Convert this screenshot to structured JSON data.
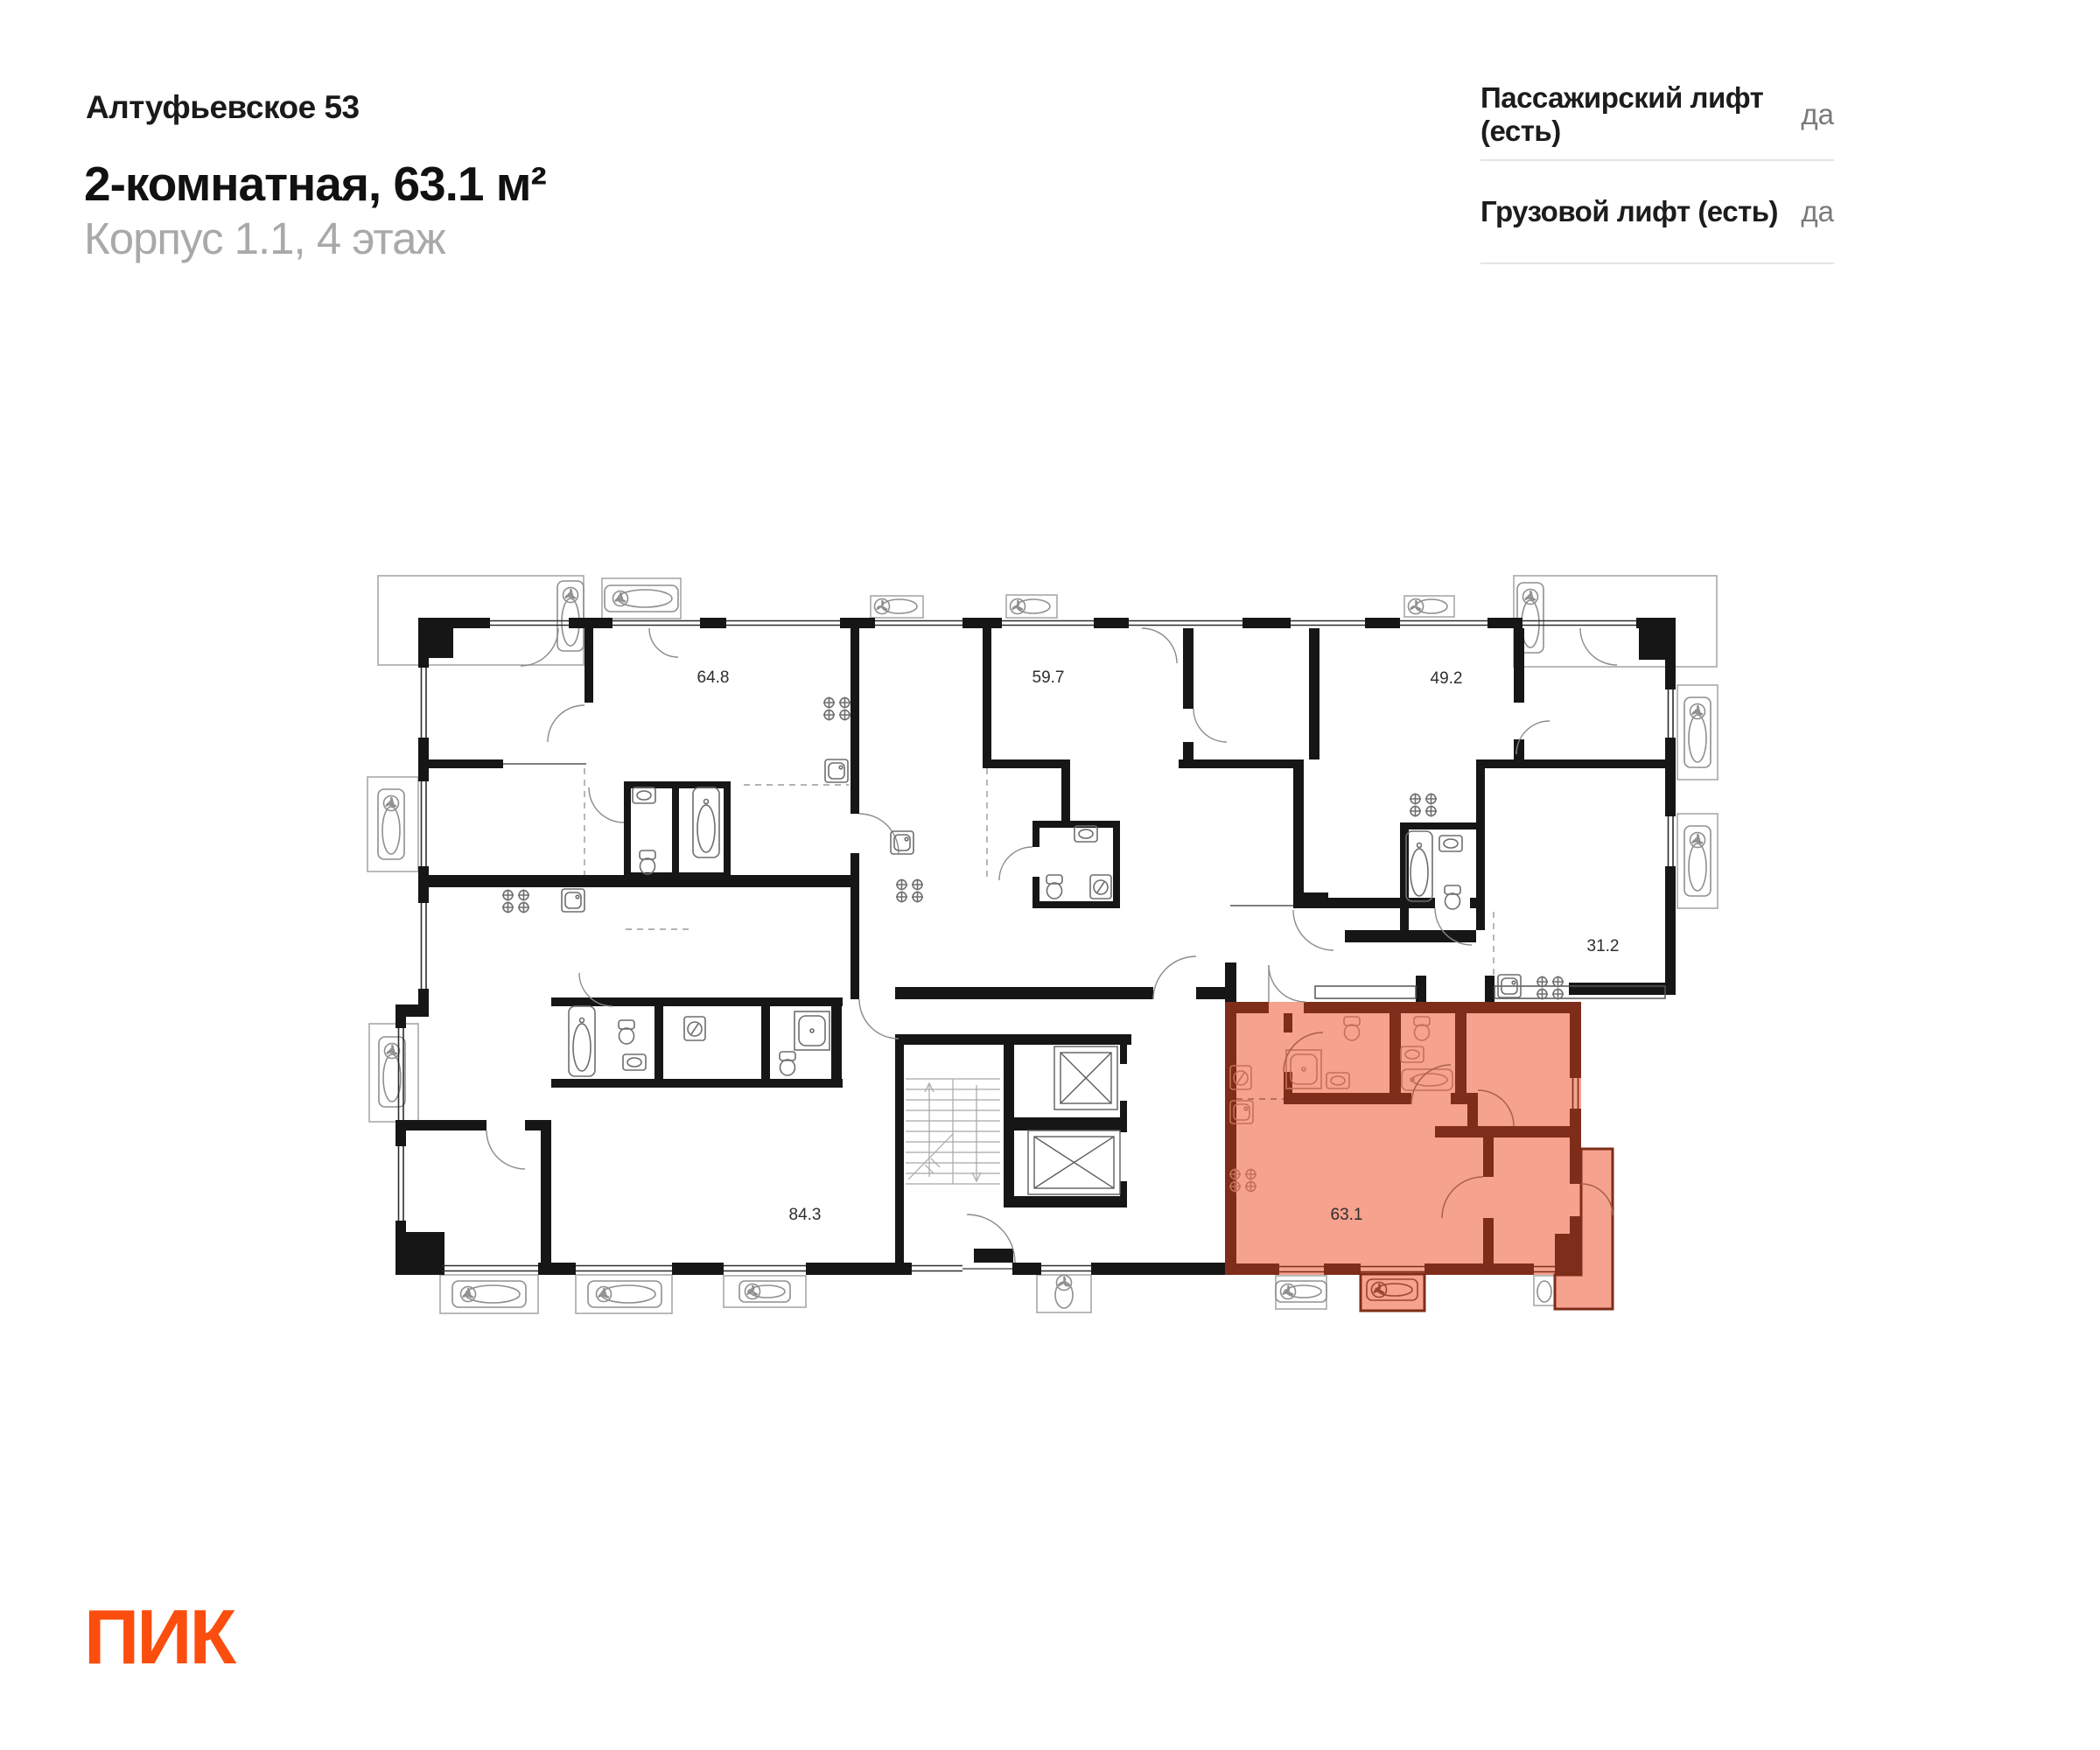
{
  "header": {
    "project_name": "Алтуфьевское 53",
    "title": "2-комнатная, 63.1 м²",
    "subtitle": "Корпус 1.1, 4 этаж"
  },
  "info_panel": {
    "rows": [
      {
        "label": "Пассажирский лифт (есть)",
        "value": "да"
      },
      {
        "label": "Грузовой лифт (есть)",
        "value": "да"
      }
    ]
  },
  "plan": {
    "units": [
      {
        "id": "unit-64-8",
        "area": "64.8"
      },
      {
        "id": "unit-59-7",
        "area": "59.7"
      },
      {
        "id": "unit-49-2",
        "area": "49.2"
      },
      {
        "id": "unit-31-2",
        "area": "31.2"
      },
      {
        "id": "unit-84-3",
        "area": "84.3"
      },
      {
        "id": "unit-63-1",
        "area": "63.1",
        "highlighted": true
      }
    ]
  },
  "footer": {
    "logo_text": "ПИК"
  },
  "colors": {
    "brand_orange": "#FB4E0E",
    "highlight_fill": "#F5A28F",
    "highlight_wall": "#7E2D1A",
    "text": "#1C1C1C",
    "subtitle_gray": "#A9A9A9",
    "value_gray": "#7A7A7A",
    "divider": "#E4E4E4",
    "wall_black": "#161616"
  }
}
